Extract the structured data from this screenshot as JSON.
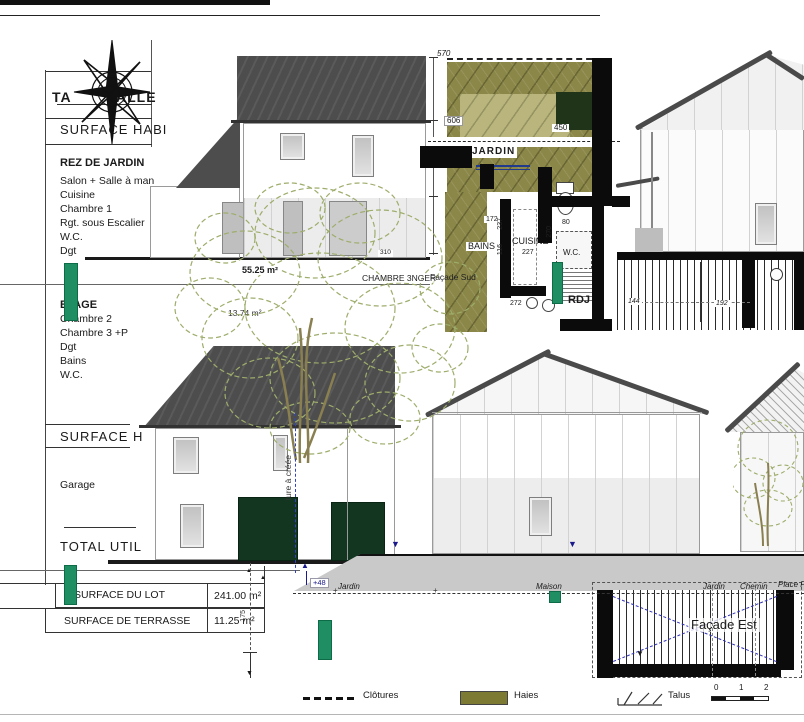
{
  "panel": {
    "title_fragment_left": "TA",
    "title_fragment_right": "ALLE",
    "surface_habitable_label": "SURFACE HABI",
    "rez_title": "REZ DE JARDIN",
    "rez_items": [
      "Salon + Salle à man",
      "Cuisine",
      "Chambre 1",
      "Rgt. sous Escalier",
      "W.C.",
      "Dgt"
    ],
    "etage_title": "ETAGE",
    "etage_items": [
      "Chambre 2",
      "Chambre 3 +P",
      "Dgt",
      "Bains",
      "W.C."
    ],
    "surface_h_label": "SURFACE H",
    "garage_label": "Garage",
    "total_label": "TOTAL UTIL"
  },
  "surface_table": {
    "rows": [
      {
        "label": "SURFACE DU LOT",
        "value": "241.00 m²"
      },
      {
        "label": "SURFACE DE TERRASSE",
        "value": "11.25 m²"
      }
    ]
  },
  "plan": {
    "jardin": "JARDIN",
    "bains": "BAINS",
    "cuisine": "CUISINE",
    "wc": "W.C.",
    "rdj": "RDJ",
    "dims": {
      "d570": "570",
      "d606": "606",
      "d450": "450",
      "d310": "310",
      "d172": "172",
      "d237": "237",
      "d116": "116",
      "d227": "227",
      "d270": "270",
      "d80": "80",
      "d272": "272",
      "d144": "144",
      "d192": "192",
      "d175": "175"
    }
  },
  "annotations": {
    "area_main": "55.25 m²",
    "area_small": "13.74 m²",
    "chambre_label": "CHAMBRE 3NGER",
    "facade_sud": "Façade Sud",
    "facade_est": "Façade Est",
    "ouverture_note": "ture à créée",
    "level": "+48"
  },
  "section": {
    "labels": [
      "Jardin",
      "Maison",
      "Jardin",
      "Chemin",
      "Place Par"
    ]
  },
  "legend": {
    "clotures": "Clôtures",
    "haies": "Haies",
    "talus": "Talus",
    "scale_ticks": [
      "0",
      "1",
      "2"
    ]
  },
  "colors": {
    "olive": "#8b8748",
    "olive_light": "#b9b57d",
    "olive_legend": "#7c7a33",
    "roof_dark": "#4d4d4d",
    "green_bar": "#1f8f63",
    "door_green": "#12361f",
    "annotation_blue": "#3333b8",
    "ground_gray": "#c9c9c9",
    "foliage_green": "#9dad6b"
  }
}
